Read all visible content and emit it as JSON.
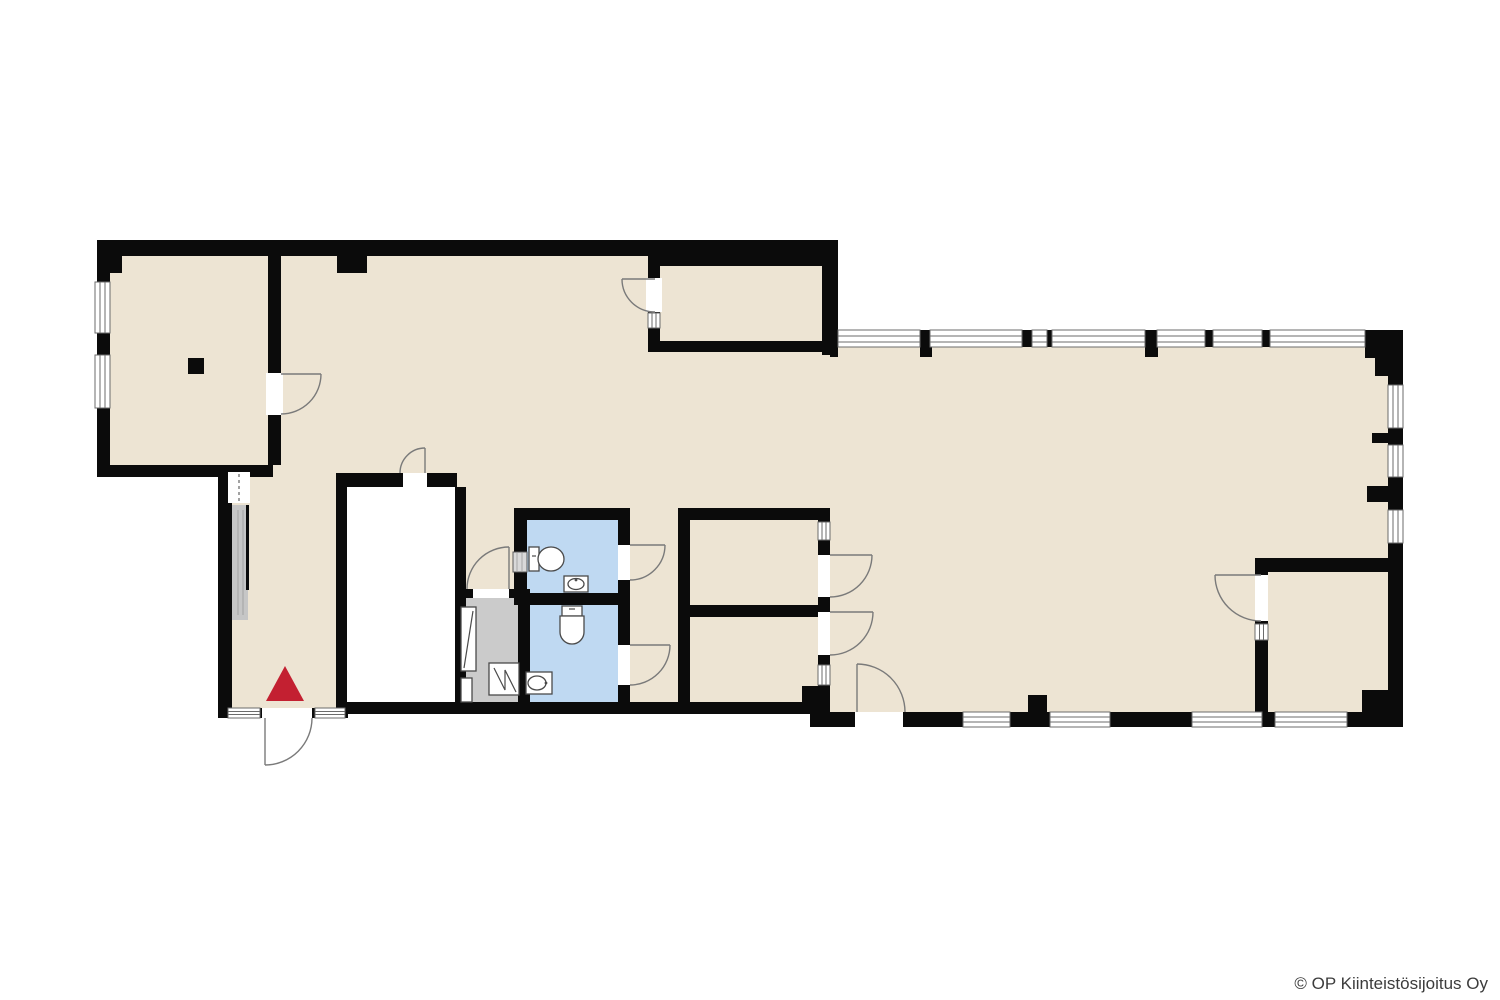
{
  "footer": {
    "copyright": "© OP Kiinteistösijoitus Oy"
  },
  "markers": {
    "entrance_marker": "red-triangle"
  },
  "colors": {
    "background": "#ffffff",
    "floor": "#ede4d3",
    "wall": "#0b0b0b",
    "wet": "#bfd9f2",
    "utility": "#cbcbcb",
    "closet": "#c6c6c6",
    "marker": "#c32031",
    "door": "#7a7a7a",
    "window": "#6b6b6b",
    "fixture": "#4a4a4a",
    "text": "#3c3c3c"
  }
}
